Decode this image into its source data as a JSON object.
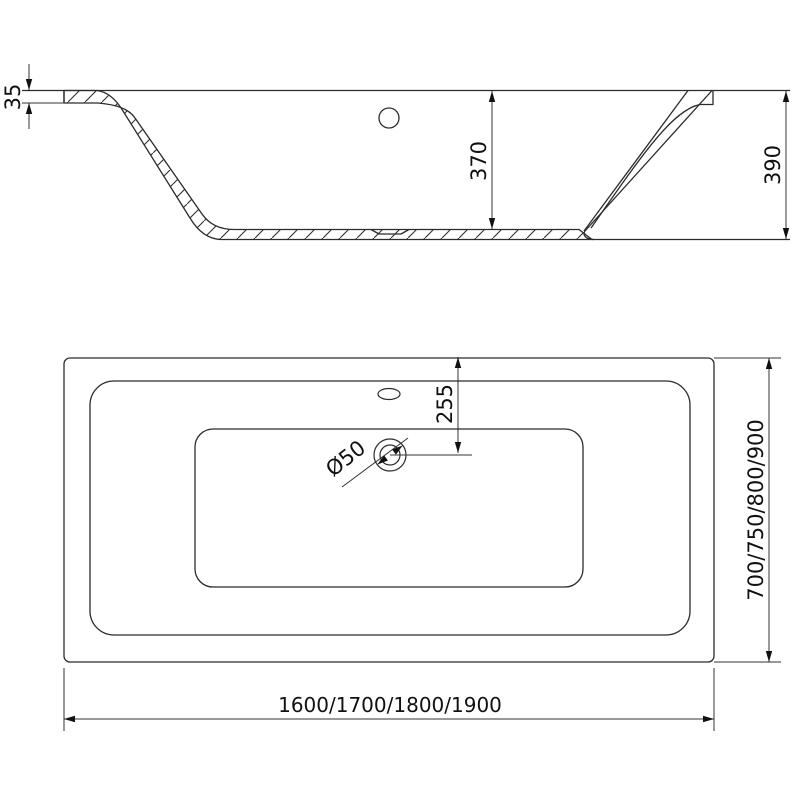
{
  "drawing": {
    "side_view": {
      "rim_thickness": "35",
      "inner_depth": "370",
      "overall_height": "390"
    },
    "plan_view": {
      "drain_offset": "255",
      "drain_diameter": "Ø50",
      "width_options": "700/750/800/900",
      "length_options": "1600/1700/1800/1900"
    }
  }
}
